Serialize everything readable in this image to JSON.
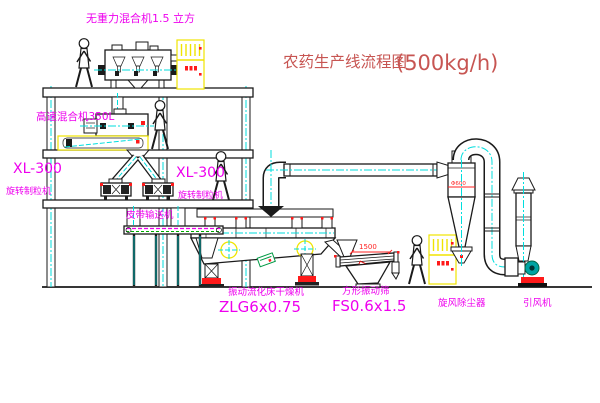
{
  "title": {
    "text": "农药生产线流程图",
    "capacity": "(500kg/h)"
  },
  "equipment_labels": {
    "gravityless_mixer": "无重力混合机1.5 立方",
    "high_speed_mixer": "高速混合机350L",
    "granulator_left": {
      "model": "XL-300",
      "name": "旋转制粒机"
    },
    "granulator_right": {
      "model": "XL-300",
      "name": "旋转制粒机"
    },
    "belt_conveyor": "皮带输送机",
    "fluid_bed_dryer": {
      "name": "振动流化床干燥机",
      "model": "ZLG6x0.75"
    },
    "square_vibrating_screen": {
      "name": "方形振动筛",
      "model": "FS0.6x1.5"
    },
    "cyclone_dust_collector": "旋风除尘器",
    "induced_draft_fan": "引风机"
  },
  "dimensions": {
    "screen_length": "1500",
    "cyclone_diameter": "Φ600"
  },
  "colors": {
    "label_magenta": "#ee00ee",
    "title_red": "#c75552",
    "centerline_cyan": "#00dede",
    "cabinet_yellow": "#f0e400",
    "accent_red": "#ff1a1a",
    "motor_teal": "#00a3a3",
    "logo_green": "#009944"
  }
}
